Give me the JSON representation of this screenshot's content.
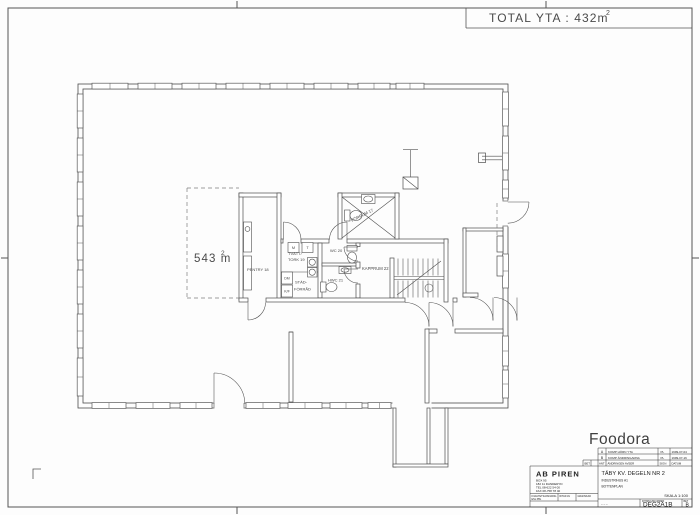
{
  "header": {
    "total_area": "TOTAL YTA : 432m",
    "total_area_sup": "2"
  },
  "plan": {
    "area_value": "543 m",
    "area_sup": "2",
    "labels": {
      "pentry": "PENTRY 18",
      "tvatt_line1": "TVÄTT/",
      "tvatt_line2": "TORK 19",
      "stad_line1": "STÄD-",
      "stad_line2": "FÖRRÅD",
      "wc": "WC 20",
      "hwc": "HWC 21",
      "kapprum": "KAPPRUM 22",
      "forrum": "FÖRRUM 17",
      "dm": "DM",
      "kf": "K/F",
      "m": "M",
      "t": "T"
    }
  },
  "titleblock": {
    "client": "Foodora",
    "revisions": {
      "rows": [
        {
          "letter": "A",
          "desc": "KOMP HÖRN YTA",
          "sign": "PL",
          "date": "1999-07-04"
        },
        {
          "letter": "B",
          "desc": "KOMP ÄNDRINGARNA",
          "sign": "PL",
          "date": "1999-07-16"
        }
      ],
      "header": {
        "bet": "BET",
        "ant": "ANT",
        "desc": "ÄNDRINGEN AVSER",
        "sign": "SIGN",
        "date": "DATUM"
      }
    },
    "company": {
      "name": "AB PIREN",
      "line1": "BOX 95",
      "line2": "182 11 DANDERYD",
      "line3": "TEL 08-622 54 00",
      "line4": "FAX 08-758 78 40",
      "cell1a": "KVALITETSANSVARIG",
      "cell1b": "ENL PBL",
      "cell2": "RITAD AV",
      "cell3": "GRANSKAD"
    },
    "project": {
      "title": "TÄBY KV. DEGELN NR 2",
      "sub1": "INDUSTRIHUS A1",
      "sub2": "BOTTENPLAN",
      "scale": "SKALA 1:100",
      "marks": "–   –   –",
      "number_label": "RITNINGSNUMMER",
      "number": "DEG2A1B",
      "bet_label": "BET",
      "bet_value": "B"
    }
  }
}
